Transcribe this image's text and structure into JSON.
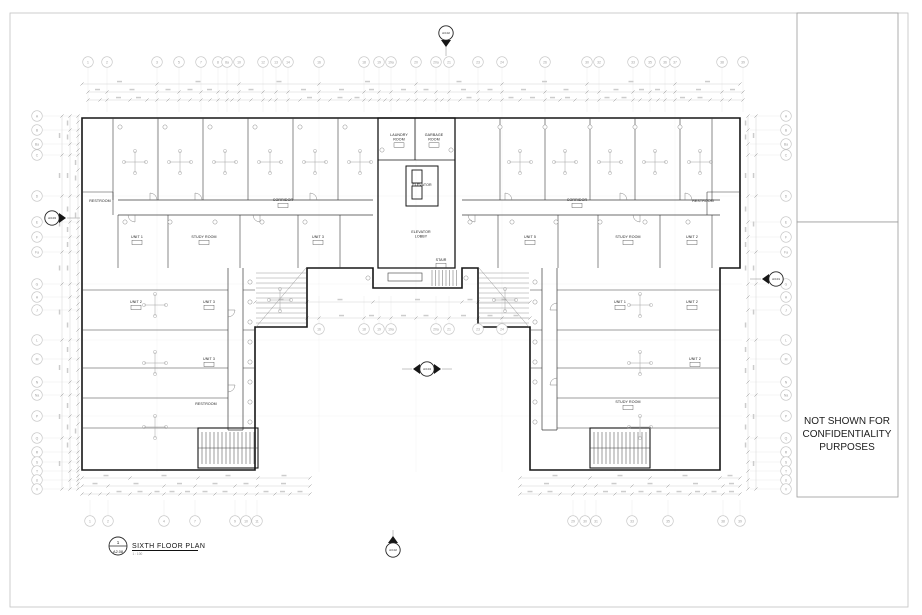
{
  "sheet": {
    "note_lines": [
      "NOT SHOWN FOR",
      "CONFIDENTIALITY",
      "PURPOSES"
    ],
    "title_block": {
      "detail_number": "1",
      "sheet_number": "A2.08",
      "title": "SIXTH FLOOR PLAN",
      "scale": "1 : 100"
    }
  },
  "colors": {
    "wall": "#161616",
    "partition": "#3c3c3c",
    "fine": "#8c8c8c",
    "grid": "#cfcfcf",
    "faint": "#e4e4e4",
    "bubble": "#c4c4c4",
    "bubble_text": "#9e9e9e",
    "label": "#1a1a1a",
    "marker": "#222222",
    "frame": "#c2c2c2"
  },
  "grid_bubbles": {
    "top": {
      "y": 62,
      "items": [
        [
          "1",
          88
        ],
        [
          "2",
          107
        ],
        [
          "3",
          157
        ],
        [
          "5",
          179
        ],
        [
          "7",
          201
        ],
        [
          "8",
          218
        ],
        [
          "8a",
          227
        ],
        [
          "10",
          239
        ],
        [
          "12",
          263
        ],
        [
          "13",
          276
        ],
        [
          "14",
          288
        ],
        [
          "16",
          319
        ],
        [
          "18",
          364
        ],
        [
          "19",
          379
        ],
        [
          "19a",
          391
        ],
        [
          "20",
          416
        ],
        [
          "20a",
          436
        ],
        [
          "21",
          449
        ],
        [
          "23",
          478
        ],
        [
          "24",
          502
        ],
        [
          "26",
          545
        ],
        [
          "30",
          587
        ],
        [
          "32",
          599
        ],
        [
          "33",
          633
        ],
        [
          "35",
          650
        ],
        [
          "36",
          665
        ],
        [
          "37",
          675
        ],
        [
          "38",
          722
        ],
        [
          "39",
          743
        ]
      ]
    },
    "bottom": {
      "y": 521,
      "items": [
        [
          "1",
          90
        ],
        [
          "2",
          108
        ],
        [
          "4",
          164
        ],
        [
          "7",
          195
        ],
        [
          "9",
          235
        ],
        [
          "10",
          246
        ],
        [
          "11",
          257
        ],
        [
          "29",
          573
        ],
        [
          "30",
          585
        ],
        [
          "31",
          596
        ],
        [
          "33",
          632
        ],
        [
          "35",
          668
        ],
        [
          "38",
          723
        ],
        [
          "39",
          740
        ]
      ]
    },
    "left": {
      "x": 37,
      "items": [
        [
          "A",
          116
        ],
        [
          "B",
          130
        ],
        [
          "Ba",
          144
        ],
        [
          "C",
          155
        ],
        [
          "D",
          196
        ],
        [
          "E",
          222
        ],
        [
          "F",
          237
        ],
        [
          "Fa",
          252
        ],
        [
          "G",
          284
        ],
        [
          "H",
          297
        ],
        [
          "J",
          310
        ],
        [
          "L",
          340
        ],
        [
          "M",
          359
        ],
        [
          "N",
          382
        ],
        [
          "Na",
          395
        ],
        [
          "P",
          416
        ],
        [
          "Q",
          438
        ],
        [
          "R",
          452
        ],
        [
          "S",
          462
        ],
        [
          "T",
          471
        ],
        [
          "U",
          480
        ],
        [
          "V",
          489
        ]
      ]
    },
    "right": {
      "x": 786,
      "items": [
        [
          "A",
          116
        ],
        [
          "B",
          130
        ],
        [
          "Ba",
          144
        ],
        [
          "C",
          155
        ],
        [
          "D",
          196
        ],
        [
          "E",
          222
        ],
        [
          "F",
          237
        ],
        [
          "Fa",
          252
        ],
        [
          "G",
          284
        ],
        [
          "H",
          297
        ],
        [
          "J",
          310
        ],
        [
          "L",
          340
        ],
        [
          "M",
          359
        ],
        [
          "N",
          382
        ],
        [
          "Na",
          395
        ],
        [
          "P",
          416
        ],
        [
          "Q",
          438
        ],
        [
          "R",
          452
        ],
        [
          "S",
          462
        ],
        [
          "T",
          471
        ],
        [
          "U",
          480
        ],
        [
          "V",
          489
        ]
      ]
    },
    "courtyard": {
      "y": 329,
      "items": [
        [
          "16",
          319
        ],
        [
          "18",
          364
        ],
        [
          "19",
          379
        ],
        [
          "19a",
          391
        ],
        [
          "20a",
          436
        ],
        [
          "21",
          449
        ],
        [
          "23",
          478
        ],
        [
          "24",
          502
        ]
      ]
    }
  },
  "section_markers": [
    {
      "label": "A3.02",
      "x": 446,
      "y": 33,
      "dir": "down"
    },
    {
      "label": "A3.03",
      "x": 52,
      "y": 218,
      "dir": "right"
    },
    {
      "label": "A3.01",
      "x": 776,
      "y": 279,
      "dir": "left"
    },
    {
      "label": "A3.04",
      "x": 427,
      "y": 369,
      "dir": "both"
    },
    {
      "label": "A3.02",
      "x": 393,
      "y": 550,
      "dir": "up"
    }
  ],
  "rooms": [
    {
      "lines": [
        "LAUNDRY",
        "ROOM"
      ],
      "x": 399,
      "y": 136,
      "tag": true
    },
    {
      "lines": [
        "GARBAGE",
        "ROOM"
      ],
      "x": 434,
      "y": 136,
      "tag": true
    },
    {
      "lines": [
        "ELEVATOR"
      ],
      "x": 422,
      "y": 186,
      "tag": false
    },
    {
      "lines": [
        "ELEVATOR",
        "LOBBY"
      ],
      "x": 421,
      "y": 233,
      "tag": false
    },
    {
      "lines": [
        "STAIR"
      ],
      "x": 441,
      "y": 261,
      "tag": true
    },
    {
      "lines": [
        "RESTROOM"
      ],
      "x": 100,
      "y": 202,
      "tag": false
    },
    {
      "lines": [
        "CORRIDOR"
      ],
      "x": 283,
      "y": 201,
      "tag": true
    },
    {
      "lines": [
        "CORRIDOR"
      ],
      "x": 577,
      "y": 201,
      "tag": true
    },
    {
      "lines": [
        "RESTROOM"
      ],
      "x": 703,
      "y": 202,
      "tag": false
    },
    {
      "lines": [
        "UNIT 1"
      ],
      "x": 137,
      "y": 238,
      "tag": true
    },
    {
      "lines": [
        "STUDY ROOM"
      ],
      "x": 204,
      "y": 238,
      "tag": true
    },
    {
      "lines": [
        "UNIT 3"
      ],
      "x": 318,
      "y": 238,
      "tag": true
    },
    {
      "lines": [
        "UNIT 5"
      ],
      "x": 530,
      "y": 238,
      "tag": true
    },
    {
      "lines": [
        "STUDY ROOM"
      ],
      "x": 628,
      "y": 238,
      "tag": true
    },
    {
      "lines": [
        "UNIT 2"
      ],
      "x": 692,
      "y": 238,
      "tag": true
    },
    {
      "lines": [
        "UNIT 2"
      ],
      "x": 136,
      "y": 303,
      "tag": true
    },
    {
      "lines": [
        "UNIT 3"
      ],
      "x": 209,
      "y": 303,
      "tag": true
    },
    {
      "lines": [
        "UNIT 3"
      ],
      "x": 209,
      "y": 360,
      "tag": true
    },
    {
      "lines": [
        "RESTROOM"
      ],
      "x": 206,
      "y": 405,
      "tag": false
    },
    {
      "lines": [
        "UNIT 1"
      ],
      "x": 620,
      "y": 303,
      "tag": true
    },
    {
      "lines": [
        "UNIT 2"
      ],
      "x": 692,
      "y": 303,
      "tag": true
    },
    {
      "lines": [
        "UNIT 2"
      ],
      "x": 695,
      "y": 360,
      "tag": true
    },
    {
      "lines": [
        "STUDY ROOM"
      ],
      "x": 628,
      "y": 403,
      "tag": true
    }
  ]
}
